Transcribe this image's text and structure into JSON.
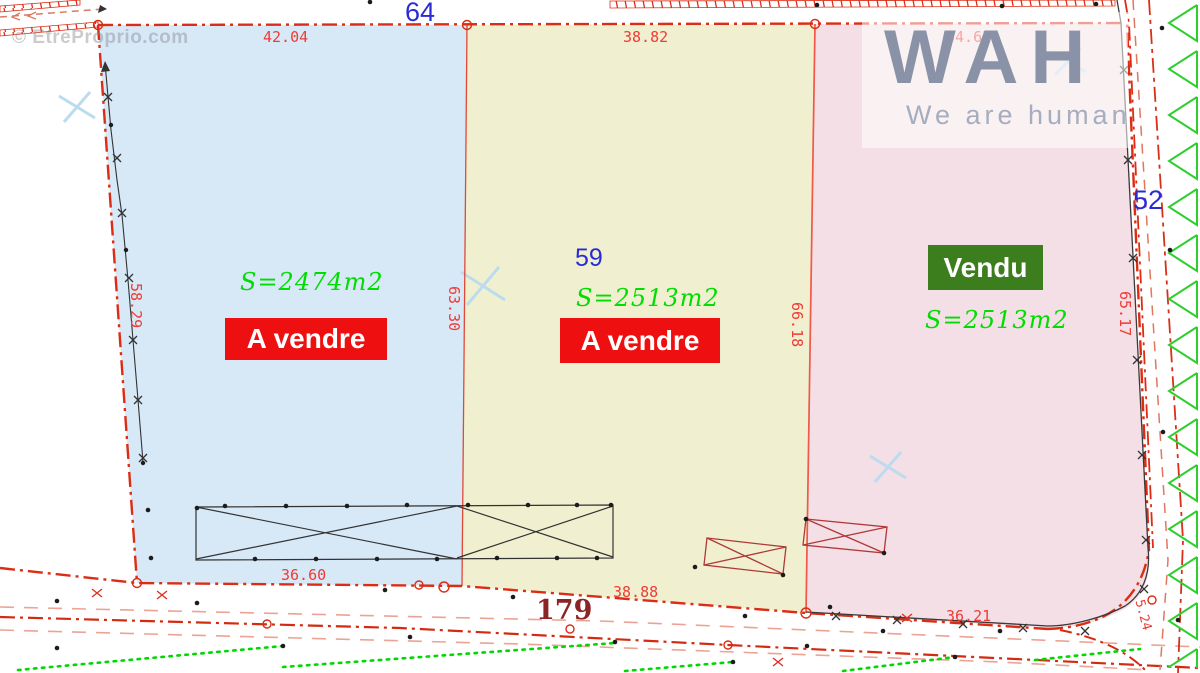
{
  "watermark": "© EtreProprio.com",
  "logo": {
    "title": "WAH",
    "subtitle": "We are human"
  },
  "parcels": [
    {
      "number": "64",
      "area_label": "S=2474m2",
      "status_label": "A vendre",
      "fill": "#d7e8f7"
    },
    {
      "number": "59",
      "area_label": "S=2513m2",
      "status_label": "A vendre",
      "fill": "#f0f0d0"
    },
    {
      "number": "52",
      "area_label": "S=2513m2",
      "status_label": "Vendu",
      "fill": "#f3dfe5"
    }
  ],
  "road_number": "179",
  "measurements": {
    "top_left": "42.04",
    "top_middle": "38.82",
    "top_right": "34.65",
    "left_side": "58.29",
    "divider_left": "63.30",
    "divider_right": "66.18",
    "right_side": "65.17",
    "bottom_left": "36.60",
    "bottom_middle": "38.88",
    "bottom_right": "36.21",
    "corner_right": "5.24"
  },
  "colors": {
    "boundary_red": "#dc2c14",
    "measure_red": "#ef3b35",
    "parcel_number_blue": "#2b2bd6",
    "area_green": "#00dd00",
    "for_sale_bg": "#ee1010",
    "sold_bg": "#3c7d1d",
    "hatch_green": "#2fce2f",
    "road_number_maroon": "#8b2424",
    "survey_black": "#333333",
    "cyan_cross": "#bcdcee"
  }
}
